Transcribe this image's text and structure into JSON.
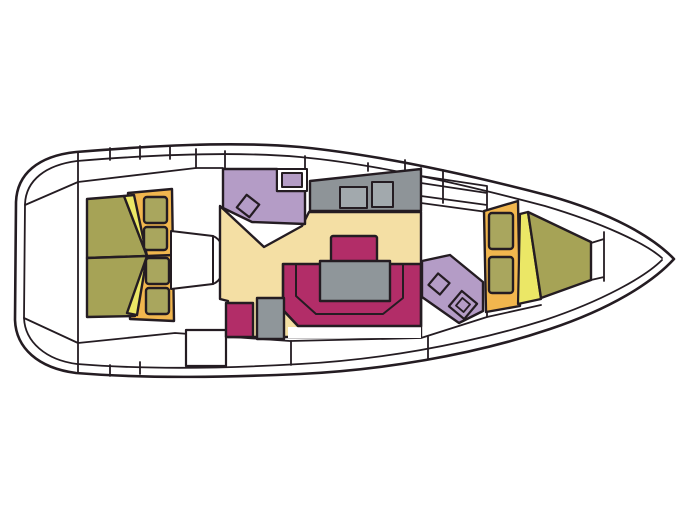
{
  "canvas": {
    "width": 691,
    "height": 518,
    "background": "#ffffff"
  },
  "diagram": {
    "type": "yacht-interior-floor-plan",
    "orientation": "bow-right",
    "regions": [
      "hull",
      "side-decks",
      "stern-platform",
      "aft-cabin-berth",
      "aft-cabin-lockers",
      "companionway-steps",
      "salon-floor",
      "aft-head",
      "galley",
      "dinette-settee",
      "dinette-table",
      "side-seat",
      "cabinet",
      "forward-head-fixtures",
      "forward-lockers",
      "forward-v-berth",
      "anchor-locker",
      "boarding-gate"
    ]
  },
  "colors": {
    "outline": "#241c22",
    "deck": "#ffffff",
    "floor": "#f4dfa4",
    "berth": "#a6a356",
    "wedge": "#ebe766",
    "cabinet": "#f1b64e",
    "locker": "#a9a65e",
    "head": "#b49cc6",
    "settee": "#b22d68",
    "galley": "#8e9498",
    "table": "#8f969a",
    "appliance": "#a2a9ad"
  }
}
